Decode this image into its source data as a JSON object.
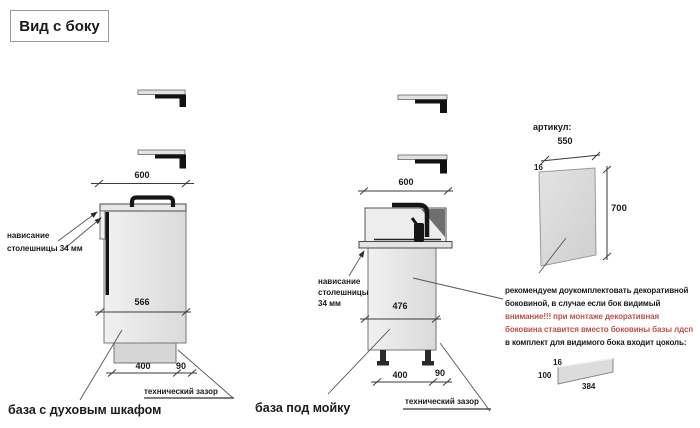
{
  "title": "Вид с боку",
  "colors": {
    "accent_red": "#c0504d",
    "panel_fill": "#d9d9d9"
  },
  "left_cabinet": {
    "caption": "база с духовым шкафом",
    "overhang_line1": "нависание",
    "overhang_line2": "столешницы 34 мм",
    "tech_gap": "технический зазор",
    "dims": {
      "top_width": "600",
      "inner_depth": "566",
      "plinth_depth": "400",
      "gap": "90"
    }
  },
  "sink_cabinet": {
    "caption": "база под мойку",
    "overhang_line1": "нависание",
    "overhang_line2": "столешницы",
    "overhang_line3": "34 мм",
    "tech_gap": "технический зазор",
    "dims": {
      "top_width": "600",
      "inner_depth": "476",
      "plinth_depth": "400",
      "gap": "90"
    }
  },
  "side_panel": {
    "heading": "артикул:",
    "dims": {
      "width": "550",
      "thickness": "16",
      "height": "700"
    },
    "note": {
      "lines": [
        "рекомендуем доукомплектовать декоративной",
        "боковиной, в случае если бок видимый",
        "внимание!!! при монтаже декоративная",
        "боковина ставится вместо боковины базы лдсп",
        "в комплект для видимого бока входит цоколь:"
      ]
    },
    "plinth": {
      "thickness": "16",
      "height": "100",
      "length": "384"
    }
  }
}
